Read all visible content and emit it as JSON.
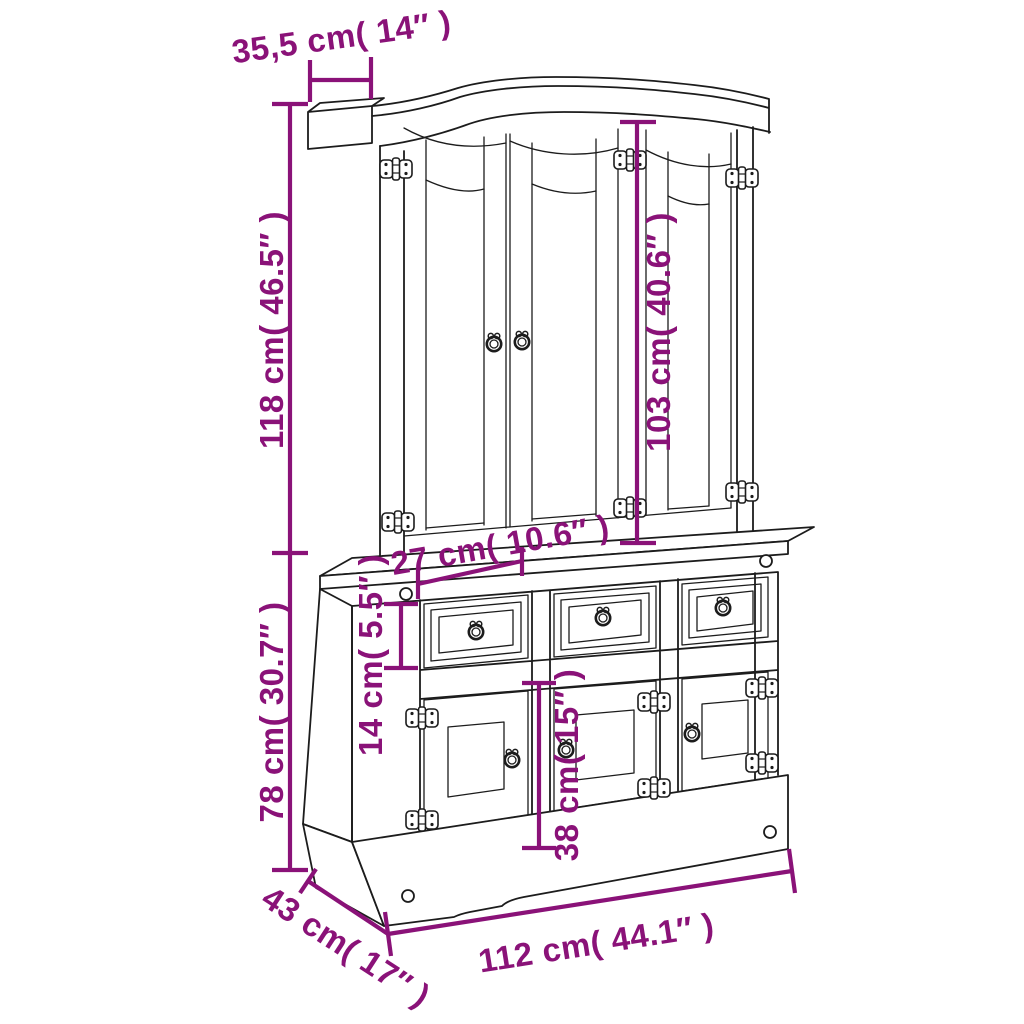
{
  "diagram": {
    "type": "furniture-dimension-diagram",
    "subject": "3-door hutch buffet cabinet line drawing with dimension annotations"
  },
  "colors": {
    "dimension": "#8a1278",
    "line_art": "#1c1c1c",
    "background": "#ffffff"
  },
  "dimensions": {
    "top_depth": "35,5 cm( 14″ )",
    "hutch_height": "118 cm( 46.5″ )",
    "hutch_door_height": "103 cm( 40.6″ )",
    "hutch_depth": "27 cm( 10.6″ )",
    "drawer_height": "14 cm( 5.5″ )",
    "base_height": "78 cm( 30.7″ )",
    "base_door_height": "38 cm( 15″ )",
    "overall_depth": "43 cm( 17″ )",
    "overall_width": "112 cm( 44.1″ )"
  }
}
